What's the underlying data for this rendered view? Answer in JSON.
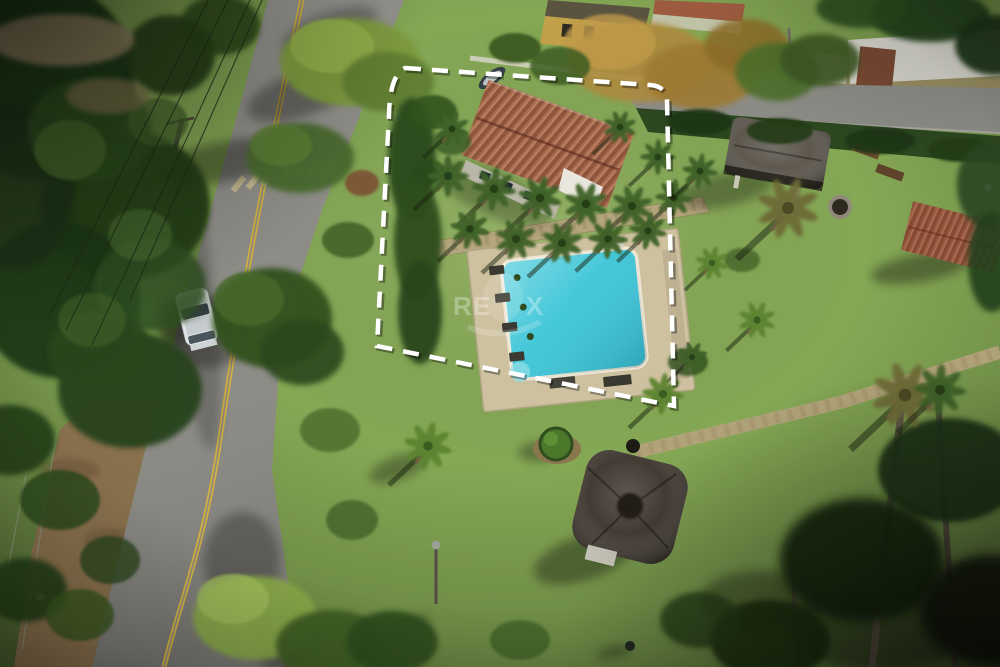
{
  "watermark": {
    "brand_left": "RE",
    "brand_right": "X",
    "color": "#ffffff"
  },
  "scene_colors": {
    "lawn": "#85a855",
    "road": "#8a8983",
    "road_line_yellow": "#d4b13e",
    "dirt_shoulder": "#8a6f4e",
    "pool_water": "#38c4d6",
    "pool_deck": "#cec19f",
    "house_roof": "#aa6b4d",
    "gazebo_thatch": "#3b332b",
    "boundary_line": "#ffffff"
  }
}
